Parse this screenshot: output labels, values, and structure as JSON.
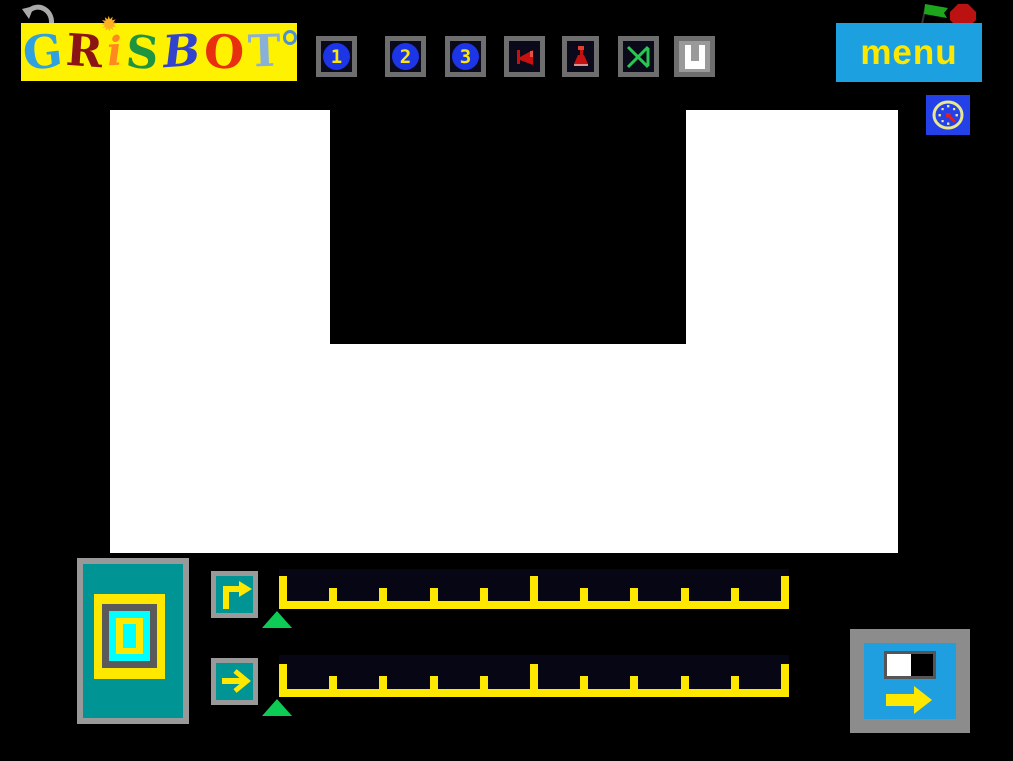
{
  "header": {
    "logo": {
      "bg_color": "#fff200",
      "title": "GRiSBOT",
      "letters": [
        {
          "ch": "G",
          "color": "#2fa0e0"
        },
        {
          "ch": "R",
          "color": "#8b1515"
        },
        {
          "ch": "i",
          "color": "#ff8820",
          "decor": "sun"
        },
        {
          "ch": "S",
          "color": "#1f9440"
        },
        {
          "ch": "B",
          "color": "#3344cc"
        },
        {
          "ch": "O",
          "color": "#e83010"
        },
        {
          "ch": "T",
          "color": "#88b0d8"
        }
      ],
      "sun_glyph": "✹"
    },
    "toolbar": {
      "buttons": [
        {
          "name": "program-1-button",
          "label": "1",
          "icon": "digit-1-on-blue-circle"
        },
        {
          "name": "program-2-button",
          "label": "2",
          "icon": "digit-2-on-blue-circle"
        },
        {
          "name": "program-3-button",
          "label": "3",
          "icon": "digit-3-on-blue-circle"
        },
        {
          "name": "flag-tool-button",
          "icon": "red-horn-flag"
        },
        {
          "name": "lamp-tool-button",
          "icon": "red-lamp"
        },
        {
          "name": "cross-tool-button",
          "icon": "green-bowtie-cross"
        },
        {
          "name": "magnet-tool-button",
          "icon": "white-u-magnet"
        }
      ]
    },
    "menu_label": "menu",
    "icons": {
      "undo": "curved-arrow-left",
      "run": "green-flag",
      "stop": "red-octagon",
      "clock": "yellow-clock-on-blue"
    }
  },
  "colors": {
    "accent_blue": "#1ca0e0",
    "accent_yellow": "#ffe800",
    "teal": "#009494",
    "bright_cyan": "#00ffff",
    "toolbar_navy": "#0a0a1a",
    "timeline_navy": "#060614",
    "pointer_green": "#0ccc55",
    "icon_red": "#c81010",
    "frame_gray": "#6e6e6e"
  },
  "stage": {
    "background": "#ffffff",
    "obstacle": "black-notch-top-center"
  },
  "control_panel": {
    "robot_sprite": "nested-squares-robot",
    "rows": [
      {
        "command": "turn-right",
        "ticks": 11,
        "major_every": 5,
        "pointer_index": 0,
        "steps_filled": 0
      },
      {
        "command": "move-forward",
        "ticks": 11,
        "major_every": 5,
        "pointer_index": 0,
        "steps_filled": 0
      }
    ]
  },
  "go_button": {
    "icon": "step-forward-arrow",
    "cells": [
      "white",
      "black"
    ]
  }
}
